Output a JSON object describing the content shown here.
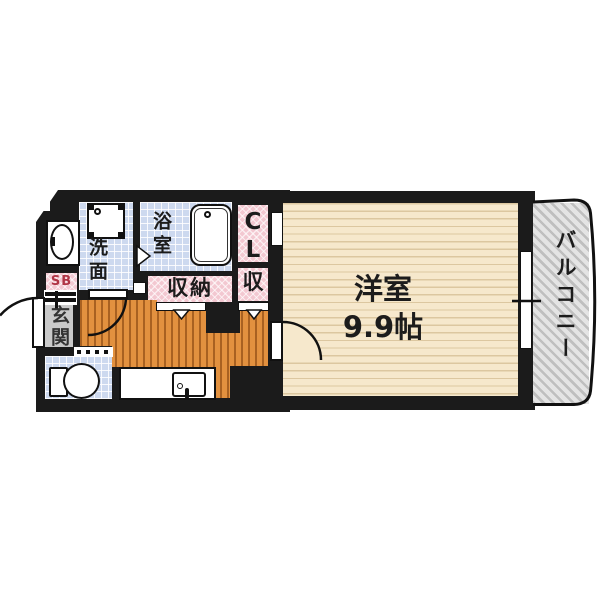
{
  "floorplan": {
    "rooms": {
      "western_room": {
        "label": "洋室",
        "size": "9.9帖"
      },
      "balcony": {
        "label": "バルコニー"
      },
      "washroom": {
        "label": "洗面"
      },
      "bathroom": {
        "label": "浴室"
      },
      "closet": {
        "label": "CL"
      },
      "storage": {
        "label": "収納"
      },
      "storage_small": {
        "label": "収"
      },
      "entrance": {
        "label": "玄関"
      },
      "shoe_box": {
        "label": "SB"
      }
    },
    "colors": {
      "wall": "#1b1b1b",
      "tile_blue": "#cdd9ef",
      "closet_pink": "#f3c8d1",
      "wood_orange": "#e2913f",
      "room_cream": "#f6e8cc",
      "entrance_gray": "#c9c9c9",
      "balcony_gray": "#dcdcdc",
      "fixture_white": "#ffffff"
    }
  }
}
